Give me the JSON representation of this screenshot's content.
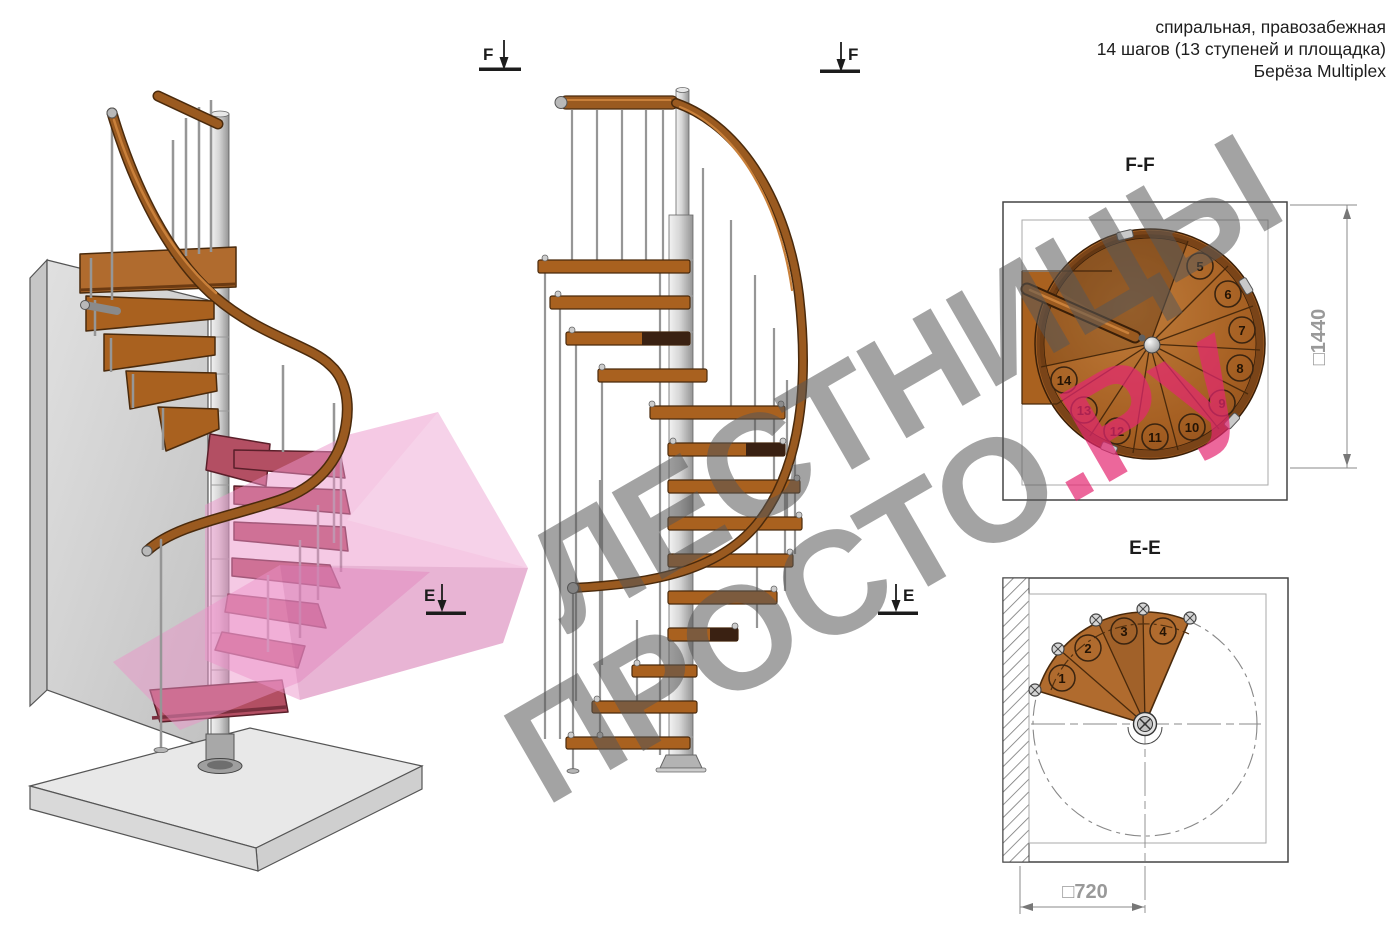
{
  "header": {
    "line1": "спиральная, правозабежная",
    "line2": "14 шагов (13 ступеней и площадка)",
    "line3": "Берёза Multiplex"
  },
  "watermark": {
    "word1": "ЛЕСТНИЦЫ",
    "word2": "ПРОСТО",
    "word2_suffix": ".Ру"
  },
  "markers": {
    "f": "F",
    "e": "E"
  },
  "ff_plan": {
    "title": "F-F",
    "dimension_label": "□1440",
    "step_numbers": [
      "5",
      "6",
      "7",
      "8",
      "9",
      "10",
      "11",
      "12",
      "13",
      "14"
    ]
  },
  "ee_plan": {
    "title": "E-E",
    "dimension_label": "□720",
    "step_numbers": [
      "1",
      "2",
      "3",
      "4"
    ]
  },
  "palette": {
    "wood": "#a9611f",
    "wood_light": "#b06b2e",
    "wood_dark": "#4a2a0c",
    "steel": "#c9c9c9",
    "section_pink": "#ec93c9",
    "highlight_step": "#b34f63",
    "dim_gray": "#999999"
  }
}
